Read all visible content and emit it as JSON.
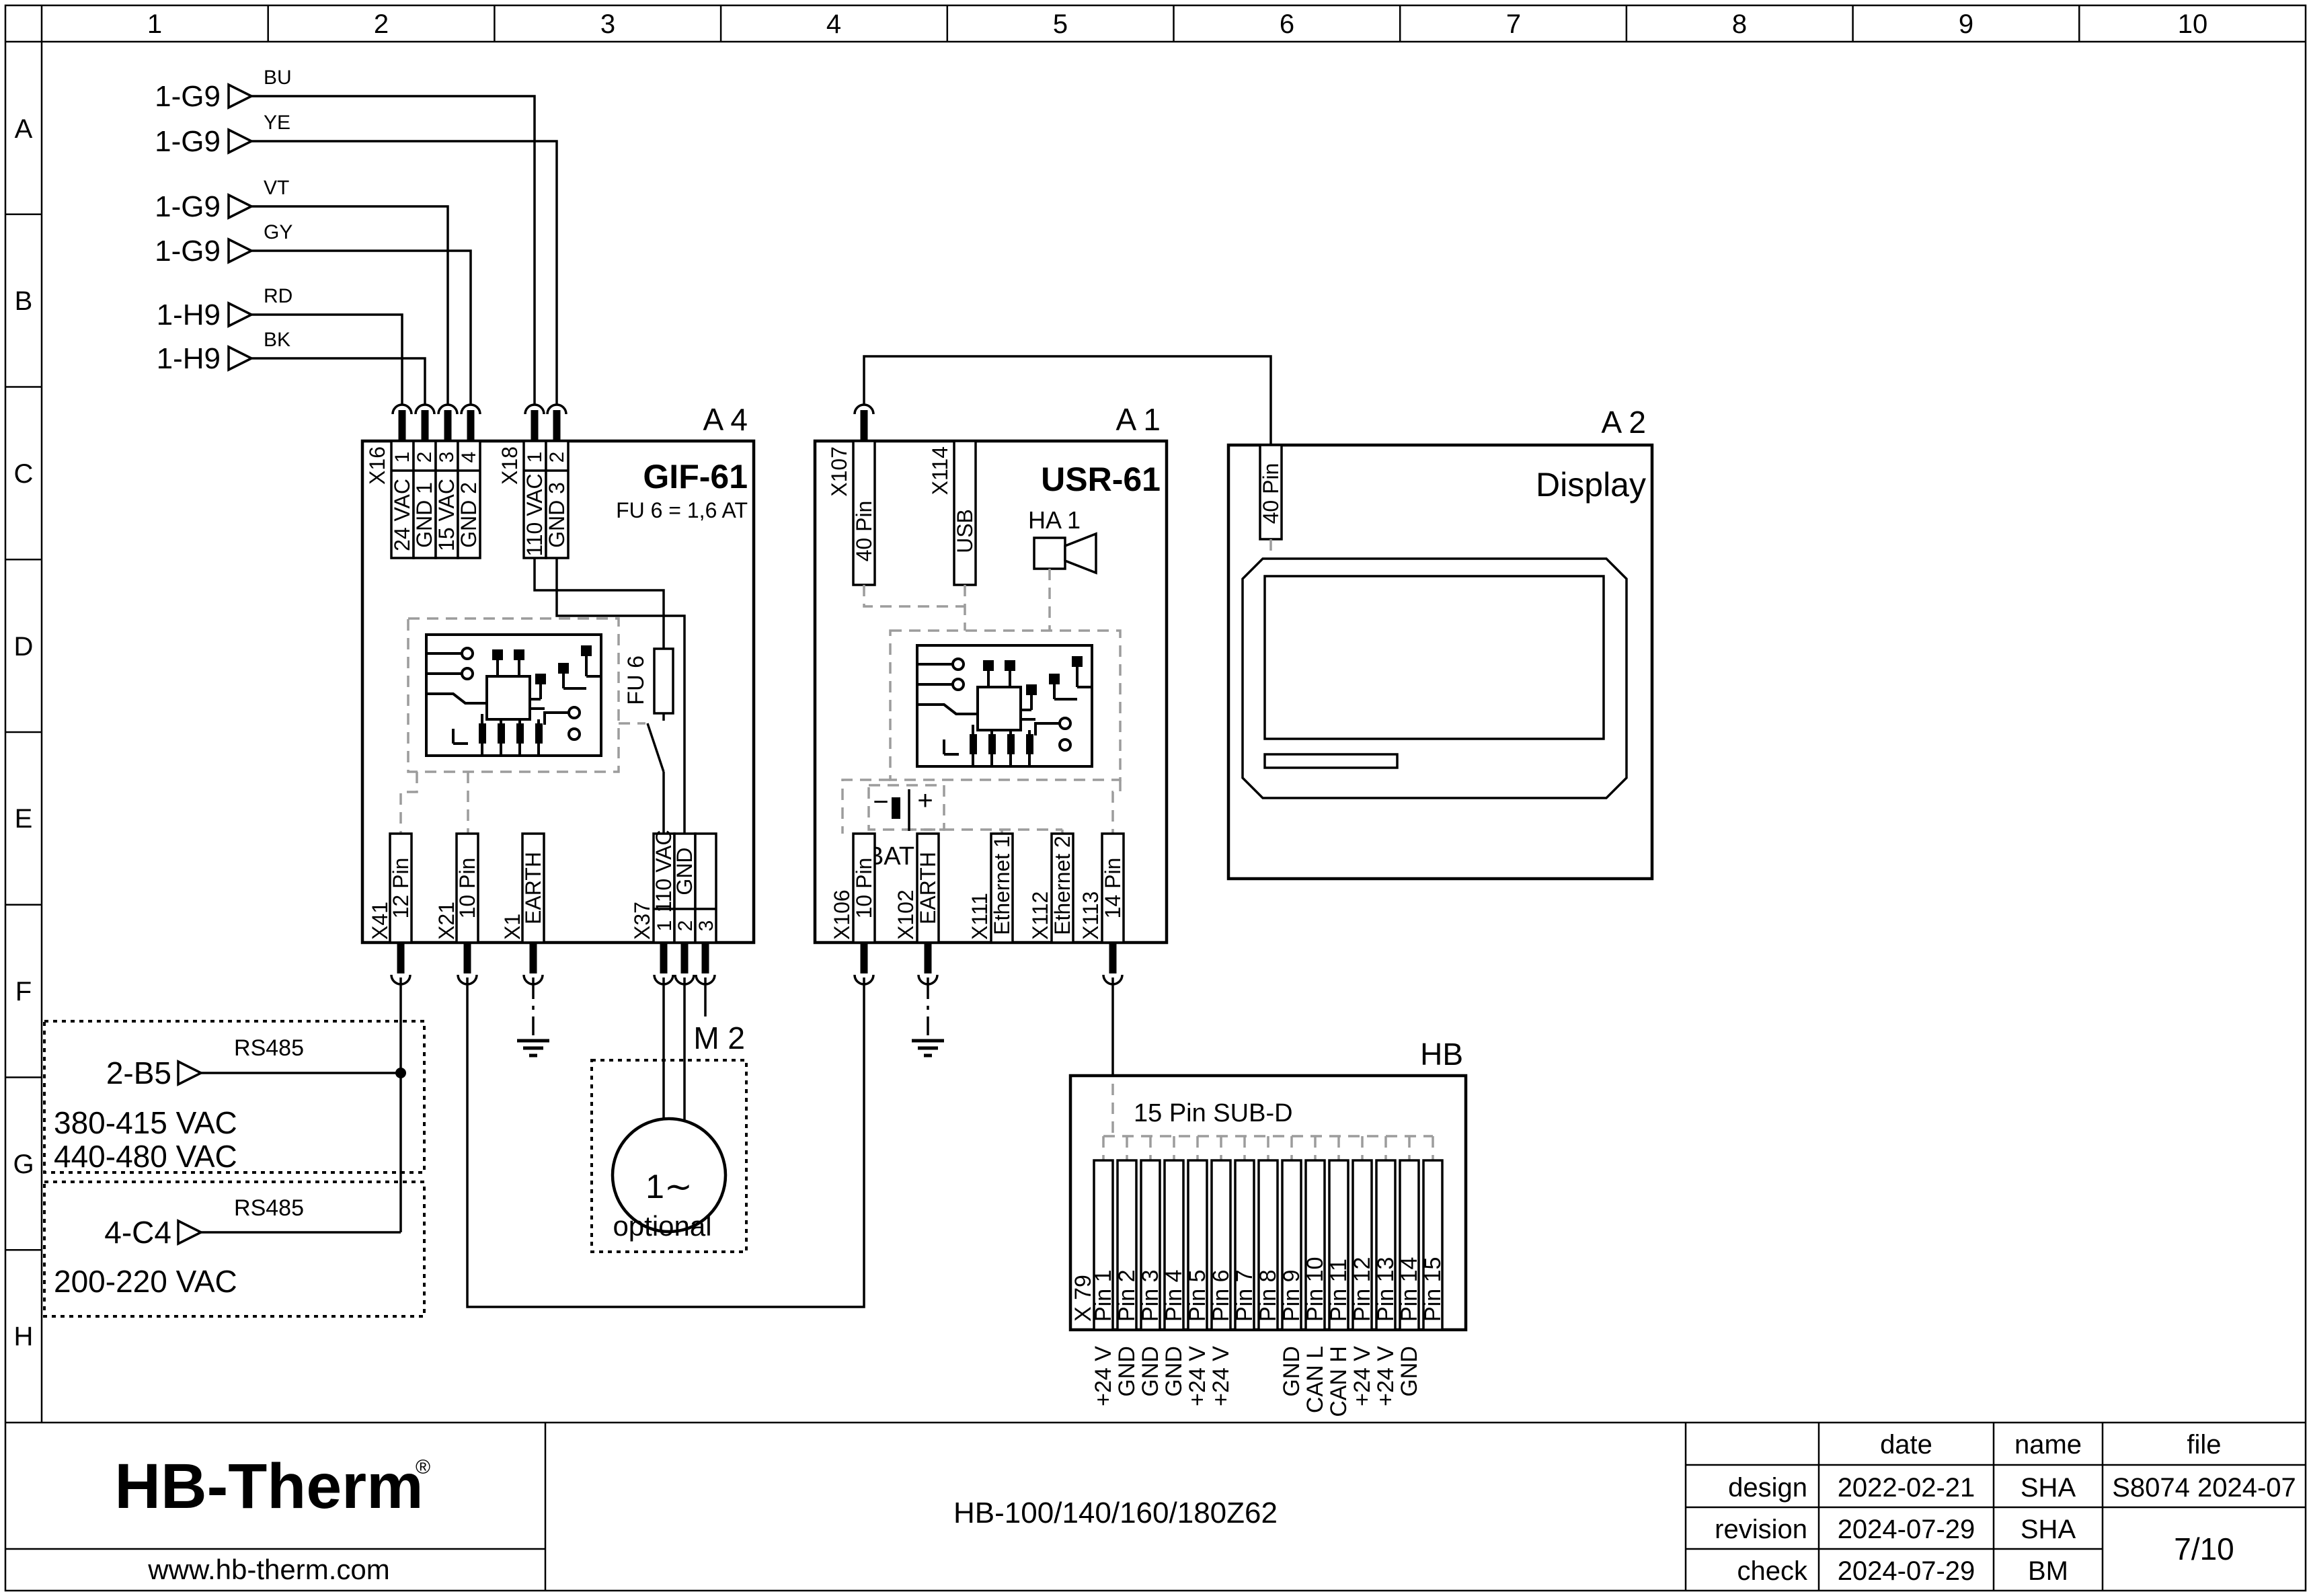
{
  "ruler": {
    "columns": [
      "1",
      "2",
      "3",
      "4",
      "5",
      "6",
      "7",
      "8",
      "9",
      "10"
    ],
    "rows": [
      "A",
      "B",
      "C",
      "D",
      "E",
      "F",
      "G",
      "H"
    ]
  },
  "inputs": [
    {
      "ref": "1-G9",
      "code": "BU"
    },
    {
      "ref": "1-G9",
      "code": "YE"
    },
    {
      "ref": "1-G9",
      "code": "VT"
    },
    {
      "ref": "1-G9",
      "code": "GY"
    },
    {
      "ref": "1-H9",
      "code": "RD"
    },
    {
      "ref": "1-H9",
      "code": "BK"
    }
  ],
  "a4": {
    "ref": "A 4",
    "title": "GIF-61",
    "fuse_rating": "FU 6 = 1,6 AT",
    "fuse": "FU 6",
    "x16": {
      "label": "X16",
      "pins": [
        "1",
        "2",
        "3",
        "4"
      ],
      "signals": [
        "24 VAC",
        "GND 1",
        "15 VAC",
        "GND 2"
      ]
    },
    "x18": {
      "label": "X18",
      "pins": [
        "1",
        "2"
      ],
      "signals": [
        "110 VAC",
        "GND 3"
      ]
    },
    "x41": {
      "label": "X41",
      "signal": "12 Pin"
    },
    "x21": {
      "label": "X21",
      "signal": "10 Pin"
    },
    "x1": {
      "label": "X1",
      "signal": "EARTH"
    },
    "x37": {
      "label": "X37",
      "pins": [
        "1",
        "2",
        "3"
      ],
      "signals": [
        "110 VAC",
        "GND"
      ]
    }
  },
  "a1": {
    "ref": "A 1",
    "title": "USR-61",
    "x107": {
      "label": "X107",
      "signal": "40 Pin"
    },
    "x114": {
      "label": "X114",
      "signal": "USB"
    },
    "horn": {
      "label": "HA 1"
    },
    "battery": {
      "label": "BAT 1",
      "minus": "−",
      "plus": "+"
    },
    "x106": {
      "label": "X106",
      "signal": "10 Pin"
    },
    "x102": {
      "label": "X102",
      "signal": "EARTH"
    },
    "x111": {
      "label": "X111",
      "signal": "Ethernet 1"
    },
    "x112": {
      "label": "X112",
      "signal": "Ethernet 2"
    },
    "x113": {
      "label": "X113",
      "signal": "14 Pin"
    }
  },
  "a2": {
    "ref": "A 2",
    "title": "Display",
    "connector": "40 Pin"
  },
  "m2": {
    "ref": "M 2",
    "symbol": "1∼",
    "note": "optional"
  },
  "hb": {
    "ref": "HB",
    "connector": "15 Pin SUB-D",
    "x_label": "X 79",
    "pins": [
      "Pin 1",
      "Pin 2",
      "Pin 3",
      "Pin 4",
      "Pin 5",
      "Pin 6",
      "Pin 7",
      "Pin 8",
      "Pin 9",
      "Pin 10",
      "Pin 11",
      "Pin 12",
      "Pin 13",
      "Pin 14",
      "Pin 15"
    ],
    "signals": [
      "+24 V",
      "GND",
      "GND",
      "GND",
      "+24 V",
      "+24 V",
      "",
      "",
      "GND",
      "CAN L",
      "CAN H",
      "+24 V",
      "+24 V",
      "GND",
      ""
    ]
  },
  "sources": [
    {
      "ref": "2-B5",
      "bus": "RS485",
      "voltages": [
        "380-415 VAC",
        "440-480 VAC"
      ]
    },
    {
      "ref": "4-C4",
      "bus": "RS485",
      "voltages": [
        "200-220 VAC"
      ]
    }
  ],
  "title_block": {
    "logo": "HB-Therm",
    "registered": "®",
    "website": "www.hb-therm.com",
    "drawing_title": "HB-100/140/160/180Z62",
    "columns": {
      "date": "date",
      "name": "name",
      "file": "file"
    },
    "rows": [
      {
        "label": "design",
        "date": "2022-02-21",
        "name": "SHA"
      },
      {
        "label": "revision",
        "date": "2024-07-29",
        "name": "SHA"
      },
      {
        "label": "check",
        "date": "2024-07-29",
        "name": "BM"
      }
    ],
    "file_value": "S8074 2024-07",
    "page": "7/10"
  },
  "colors": {
    "line": "#000000",
    "dash": "#9c9c9c",
    "logo": "#1d2946"
  }
}
